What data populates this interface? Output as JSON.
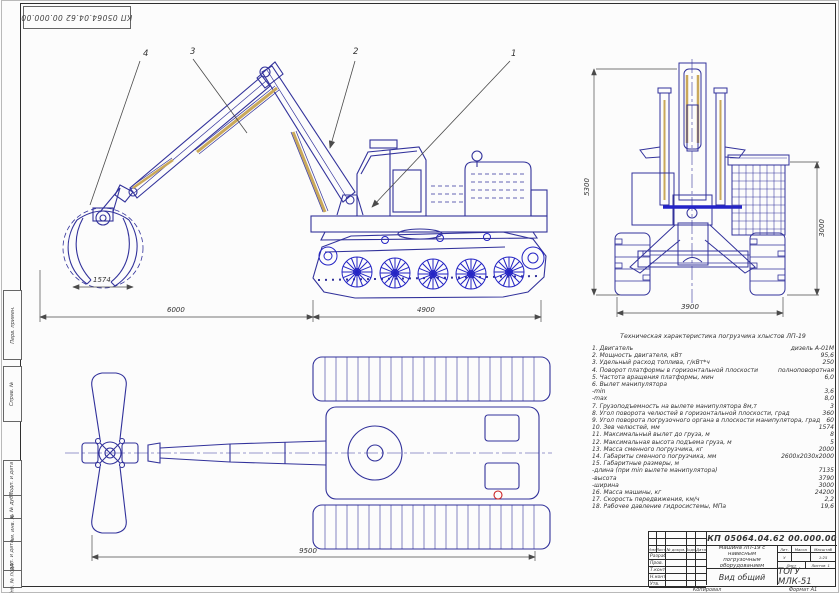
{
  "stamp": {
    "doc_number": "КП 05064.04.62 00.000.00"
  },
  "margin": {
    "labels": [
      "Перв. примен.",
      "Справ. №",
      "Подп. и дата",
      "Инв. № дубл.",
      "Взам. инв. №",
      "Подп. и дата",
      "Инв. № подл."
    ]
  },
  "callouts": [
    "1",
    "2",
    "3",
    "4"
  ],
  "dimensions": {
    "grapple_jaw": "1574",
    "side_left": "6000",
    "side_right": "4900",
    "front_height": "5300",
    "front_basket": "3000",
    "front_width": "3900",
    "plan_length": "9500"
  },
  "specs": {
    "title": "Техническая характеристика погрузчика хлыстов ЛП-19",
    "rows": [
      {
        "label": "1. Двигатель",
        "value": "дизель А-01М"
      },
      {
        "label": "2. Мощность двигателя, кВт",
        "value": "95,6"
      },
      {
        "label": "3. Удельный расход топлива, г/кВт*ч",
        "value": "250"
      },
      {
        "label": "4. Поворот платформы в горизонтальной плоскости",
        "value": "полноповоротная"
      },
      {
        "label": "5. Частота вращения платформы, мин",
        "value": "6,0"
      },
      {
        "label": "6. Вылет манипулятора",
        "value": ""
      },
      {
        "label": "-min",
        "value": "3,6"
      },
      {
        "label": "-max",
        "value": "8,0"
      },
      {
        "label": "7. Грузоподъемность на вылете манипулятора 8м,т",
        "value": "3"
      },
      {
        "label": "8. Угол поворота челюстей в горизонтальной плоскости, град",
        "value": "360"
      },
      {
        "label": "9. Угол поворота погрузочного органа в плоскости манипулятора, град",
        "value": "60"
      },
      {
        "label": "10. Зев челюстей, мм",
        "value": "1574"
      },
      {
        "label": "11. Максимальный вылет до груза, м",
        "value": "8"
      },
      {
        "label": "12. Максимальная высота подъема груза, м",
        "value": "5"
      },
      {
        "label": "13. Масса сменного погрузчика, кг",
        "value": "2000"
      },
      {
        "label": "14. Габариты сменного погрузчика, мм",
        "value": "2600х2030х2000"
      },
      {
        "label": "15. Габаритные размеры, м",
        "value": ""
      },
      {
        "label": "-длина (при min вылете манипулятора)",
        "value": "7135"
      },
      {
        "label": "-высота",
        "value": "3790"
      },
      {
        "label": "-ширина",
        "value": "3000"
      },
      {
        "label": "16. Масса машины, кг",
        "value": "24200"
      },
      {
        "label": "17. Скорость передвижения, км/ч",
        "value": "2,2"
      },
      {
        "label": "18. Рабочее давление гидросистемы, МПа",
        "value": "19,6"
      }
    ]
  },
  "title_block": {
    "doc_number": "КП 05064.04.62 00.000.00",
    "name": "Машина ЛП-19 с навесным погрузочным оборудованием",
    "doc_type": "Вид общий",
    "org": "ТОГУ МЛК-51",
    "lit_header": "Лит.",
    "mass_header": "Масса",
    "scale_header": "Масштаб",
    "lit_value": "У",
    "scale_value": "1:25",
    "sheet_label": "Лист",
    "sheets_label": "Листов",
    "sheets_value": "1",
    "header_cells": [
      "Изм.",
      "Лист",
      "№ докум.",
      "Подп.",
      "Дата"
    ],
    "roles": [
      "Разраб.",
      "Пров.",
      "Т.контр.",
      "Н.контр.",
      "Утв."
    ]
  },
  "footer": {
    "copied": "Копировал",
    "format": "Формат А1"
  },
  "colors": {
    "line": "#32329b",
    "wheel": "#2424c4",
    "accent": "#c9a85a",
    "dim": "#4a4a4a",
    "red": "#cc2222"
  }
}
